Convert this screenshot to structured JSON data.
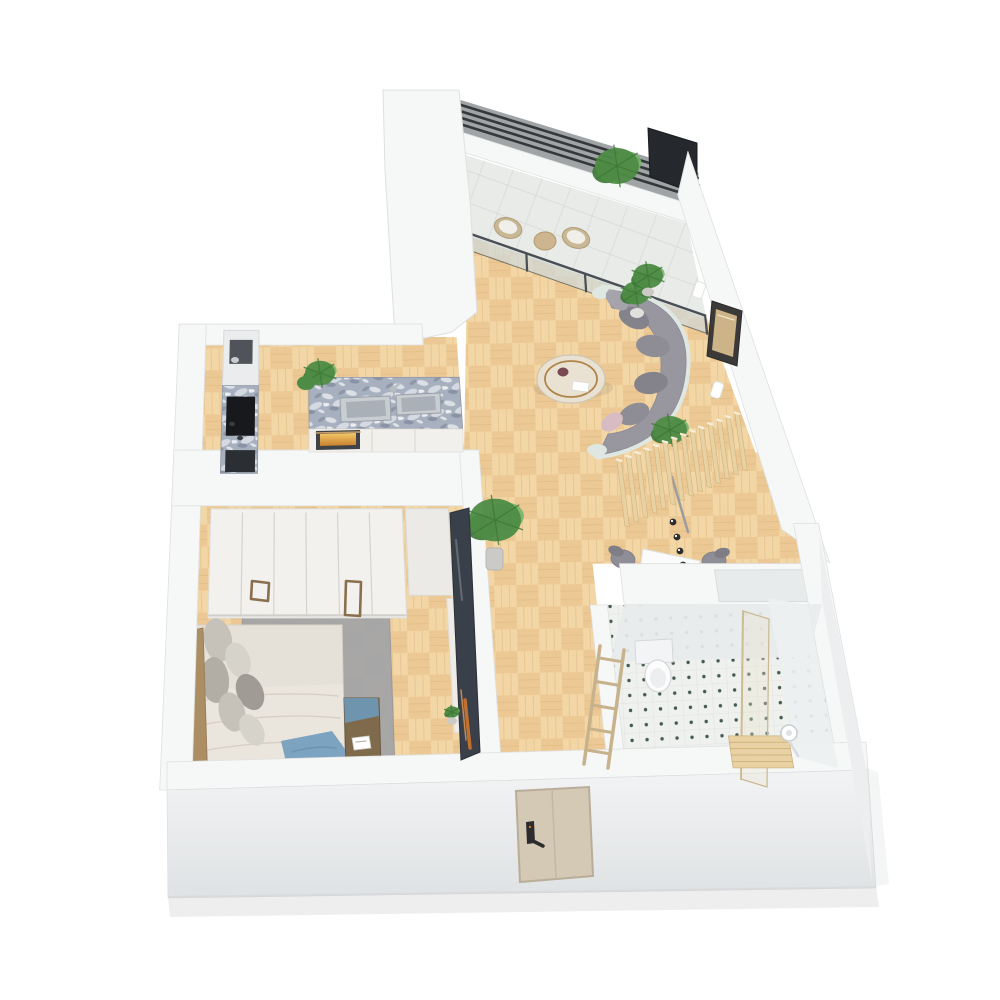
{
  "app": {
    "type": "3d-apartment-floor-plan-render",
    "view": "isometric dollhouse top view",
    "background": "#ffffff"
  },
  "colors": {
    "wall_top": "#f6f7f7",
    "wall_edge": "#dfe0e0",
    "wall_face_front_a": "#f2f3f4",
    "wall_face_front_b": "#dfe2e4",
    "wall_face_side": "#eceef0",
    "inner_face": "#e8ebec",
    "inner_face2": "#edf0f1",
    "shadow_wedge": "#9b9fa1",
    "dark_slats": "#34383b",
    "wood_floor_a": "#f0d19e",
    "wood_floor_b": "#e7c28a",
    "wood_floor_c": "#f6dcae",
    "wood_line": "#dcb57c",
    "balcony_floor": "#e9ebe8",
    "balcony_grid": "#d6d8d5",
    "tile_floor": "#eff1ef",
    "tile_grid": "#dbe0db",
    "tile_dot": "#32493d",
    "granite_base": "#a7b0bf",
    "granite_light": "#dde1e8",
    "granite_dark": "#7e8798",
    "cabinet_white": "#f2f0ec",
    "appliance_dark": "#17191c",
    "appliance_gray": "#50545a",
    "oven_body": "#3f4347",
    "oven_glow_a": "#f4c969",
    "oven_glow_b": "#c87f2e",
    "sink_steel": "#c8cdd2",
    "sink_inner": "#aab0b8",
    "sofa_gray": "#98979f",
    "sofa_dark": "#84838c",
    "sofa_mid": "#8e8d96",
    "sofa_light": "#a5a4ac",
    "sofa_trim": "#dfe7e3",
    "pillow_pink": "#d8bcc4",
    "table_marble": "#e9e2d3",
    "table_gold": "#b08448",
    "slat_wood": "#e8d2a4",
    "slat_wood_dark": "#cfb27c",
    "slat_wood_lit": "#f7eeda",
    "plant_green": "#4e8c46",
    "plant_green_dark": "#3f7a38",
    "plant_green_light": "#7ab46a",
    "pot_gray": "#cbcac6",
    "bed_linen": "#e6e1d8",
    "duvet": "#ebe6dd",
    "duvet_fold": "#d6d0c5",
    "pillow_g1": "#c6c2ba",
    "pillow_g2": "#b2aea6",
    "pillow_g3": "#d6d3cb",
    "pillow_g4": "#a09c95",
    "throw_blue": "#7ca3c0",
    "throw_fold": "#6b93b2",
    "head_wood": "#ab8e63",
    "bench_brown": "#7f6a4c",
    "bench_cloth": "#6f94ad",
    "rug_gray": "#a4a5a7",
    "wardrobe_white": "#f3f1ee",
    "wardrobe_seam": "#d6d3cf",
    "handle_bronze": "#8a6f4f",
    "tv_dark": "#3a4049",
    "tv_orange": "#d0762e",
    "glass_frame": "#4a4f55",
    "glass_pane": "#cfd9da",
    "shower_glass_edge": "#c9b78f",
    "door_wood": "#d4c9b5",
    "door_frame": "#b9ad99",
    "door_handle": "#2c2c2e",
    "desk_white": "#fbfbfc",
    "chair_gray": "#8f8e96",
    "chair_rim": "#7f7e86",
    "flower_pink": "#d5a3bf",
    "toilet_white": "#fcfcfd",
    "toilet_shadow": "#d5d8da",
    "frame_dark": "#3b3a38",
    "frame_art": "#cdb488",
    "sconce_white": "#ffffff",
    "ground_shadow": "#c9cbcd",
    "panel_dark": "#25282c",
    "chair_wood": "#c9b896",
    "cushion_white": "#f0efe9",
    "tan_table": "#cdb68f"
  },
  "scene": {
    "rooms": [
      {
        "name": "balcony",
        "items": [
          "dark-slat-railing",
          "outdoor-chair",
          "outdoor-chair",
          "round-side-table",
          "potted-palm",
          "dark-privacy-panel",
          "sliding-glass-door"
        ]
      },
      {
        "name": "living-room",
        "items": [
          "curved-sectional-sofa",
          "round-coffee-table",
          "wall-art-frame",
          "wall-sconce",
          "wall-sconce",
          "potted-plant",
          "potted-plant"
        ]
      },
      {
        "name": "kitchen",
        "items": [
          "granite-island",
          "double-sink",
          "faucet",
          "oven",
          "cooktop",
          "tall-cabinet",
          "coffee-machine",
          "dishwasher",
          "potted-plant"
        ]
      },
      {
        "name": "hallway",
        "items": [
          "potted-palm",
          "tv-media-panel",
          "tv-console"
        ]
      },
      {
        "name": "desk-nook",
        "items": [
          "wood-slat-screen",
          "desk",
          "desk-chair",
          "desk-chair",
          "pendant-lights",
          "potted-plant"
        ]
      },
      {
        "name": "bedroom",
        "items": [
          "wardrobe",
          "side-cabinet",
          "double-bed",
          "headboard",
          "pillows",
          "blue-throw-blanket",
          "area-rug",
          "foot-bench",
          "nightstand",
          "pink-flowers"
        ]
      },
      {
        "name": "bathroom",
        "items": [
          "toilet",
          "glass-shower-partition",
          "wood-shower-mat",
          "shower-head",
          "wall-niche",
          "dotted-tile-floor",
          "towel-ladder"
        ]
      },
      {
        "name": "entry",
        "items": [
          "front-door",
          "door-handle"
        ]
      }
    ]
  }
}
